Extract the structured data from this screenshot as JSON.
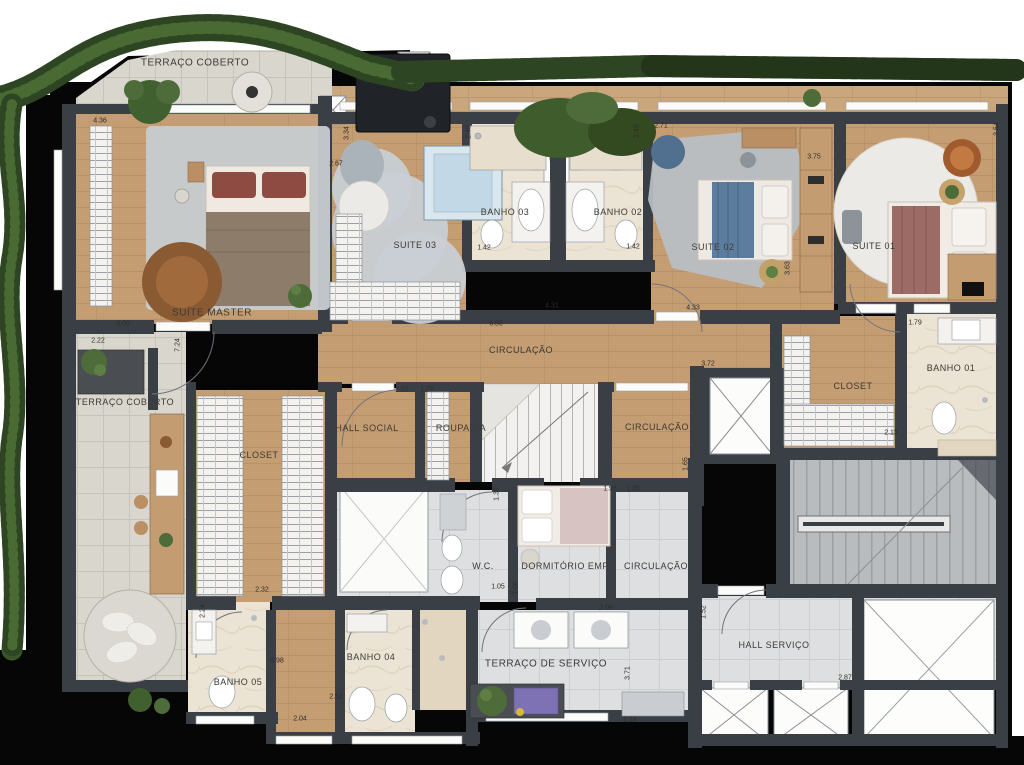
{
  "palette": {
    "wood": "#c59d72",
    "deck": "#c9a67c",
    "tile": "#d9d6ce",
    "marble": "#ebe3d4",
    "serv": "#dedfe1",
    "stair": "#b9bcbf",
    "wall": "#3a3f46",
    "black": "#060606",
    "hedge": "#3a5629",
    "hedgeDark": "#2a4120",
    "rug": "#c6ccd0"
  },
  "plan": {
    "rooms": [
      {
        "label": "TERRAÇO COBERTO",
        "x": 195,
        "y": 63,
        "big": true
      },
      {
        "label": "SUÍTE MASTER",
        "x": 212,
        "y": 313,
        "big": true
      },
      {
        "label": "SUITE 03",
        "x": 415,
        "y": 245
      },
      {
        "label": "BANHO 03",
        "x": 505,
        "y": 212
      },
      {
        "label": "BANHO 02",
        "x": 618,
        "y": 212
      },
      {
        "label": "SUITE 02",
        "x": 713,
        "y": 247
      },
      {
        "label": "SUITE 01",
        "x": 874,
        "y": 246
      },
      {
        "label": "CIRCULAÇÃO",
        "x": 521,
        "y": 350
      },
      {
        "label": "BANHO 01",
        "x": 951,
        "y": 368
      },
      {
        "label": "CLOSET",
        "x": 853,
        "y": 386
      },
      {
        "label": "TERRAÇO COBERTO",
        "x": 125,
        "y": 402
      },
      {
        "label": "HALL SOCIAL",
        "x": 367,
        "y": 428
      },
      {
        "label": "ROUPARIA",
        "x": 461,
        "y": 428
      },
      {
        "label": "CIRCULAÇÃO",
        "x": 657,
        "y": 427
      },
      {
        "label": "CLOSET",
        "x": 259,
        "y": 455
      },
      {
        "label": "W.C.",
        "x": 483,
        "y": 566
      },
      {
        "label": "DORMITÓRIO EMP.",
        "x": 566,
        "y": 566
      },
      {
        "label": "CIRCULAÇÃO",
        "x": 656,
        "y": 566
      },
      {
        "label": "BANHO 05",
        "x": 238,
        "y": 682
      },
      {
        "label": "BANHO 04",
        "x": 371,
        "y": 657
      },
      {
        "label": "TERRAÇO DE SERVIÇO",
        "x": 546,
        "y": 664,
        "big": true
      },
      {
        "label": "HALL SERVIÇO",
        "x": 774,
        "y": 645
      }
    ],
    "dimensions": [
      {
        "text": "4.36",
        "x": 100,
        "y": 121
      },
      {
        "text": "3.34",
        "x": 347,
        "y": 133,
        "v": true
      },
      {
        "text": "2.67",
        "x": 336,
        "y": 164
      },
      {
        "text": "2.45",
        "x": 469,
        "y": 132,
        "v": true
      },
      {
        "text": "2.45",
        "x": 637,
        "y": 131,
        "v": true
      },
      {
        "text": "2.71",
        "x": 661,
        "y": 126
      },
      {
        "text": "3.75",
        "x": 814,
        "y": 157
      },
      {
        "text": "3.54",
        "x": 997,
        "y": 129,
        "v": true
      },
      {
        "text": "1.42",
        "x": 484,
        "y": 248
      },
      {
        "text": "1.42",
        "x": 633,
        "y": 247
      },
      {
        "text": "4.31",
        "x": 552,
        "y": 306
      },
      {
        "text": "4.33",
        "x": 693,
        "y": 308
      },
      {
        "text": "6.80",
        "x": 496,
        "y": 324
      },
      {
        "text": "4.00",
        "x": 123,
        "y": 324
      },
      {
        "text": "2.22",
        "x": 98,
        "y": 341
      },
      {
        "text": "7.24",
        "x": 178,
        "y": 345,
        "v": true
      },
      {
        "text": "3.72",
        "x": 708,
        "y": 364
      },
      {
        "text": "1.79",
        "x": 915,
        "y": 323
      },
      {
        "text": "2.13",
        "x": 891,
        "y": 433
      },
      {
        "text": "1.51",
        "x": 402,
        "y": 390
      },
      {
        "text": "1.27",
        "x": 427,
        "y": 390
      },
      {
        "text": "3.63",
        "x": 788,
        "y": 268,
        "v": true
      },
      {
        "text": "1.65",
        "x": 686,
        "y": 464,
        "v": true
      },
      {
        "text": "1.96",
        "x": 610,
        "y": 489
      },
      {
        "text": "1.20",
        "x": 633,
        "y": 489
      },
      {
        "text": "1.30",
        "x": 497,
        "y": 494,
        "v": true
      },
      {
        "text": "1.05",
        "x": 498,
        "y": 587
      },
      {
        "text": "1.08",
        "x": 516,
        "y": 588,
        "v": true
      },
      {
        "text": "2.08",
        "x": 606,
        "y": 608
      },
      {
        "text": "2.32",
        "x": 262,
        "y": 590
      },
      {
        "text": "2.24",
        "x": 203,
        "y": 611,
        "v": true
      },
      {
        "text": "0.98",
        "x": 277,
        "y": 661
      },
      {
        "text": "2.52",
        "x": 336,
        "y": 697
      },
      {
        "text": "2.04",
        "x": 300,
        "y": 719
      },
      {
        "text": "1.52",
        "x": 704,
        "y": 612,
        "v": true
      },
      {
        "text": "3.71",
        "x": 628,
        "y": 673,
        "v": true
      },
      {
        "text": "2.87",
        "x": 845,
        "y": 678
      },
      {
        "text": "1.16",
        "x": 630,
        "y": 720
      }
    ]
  }
}
